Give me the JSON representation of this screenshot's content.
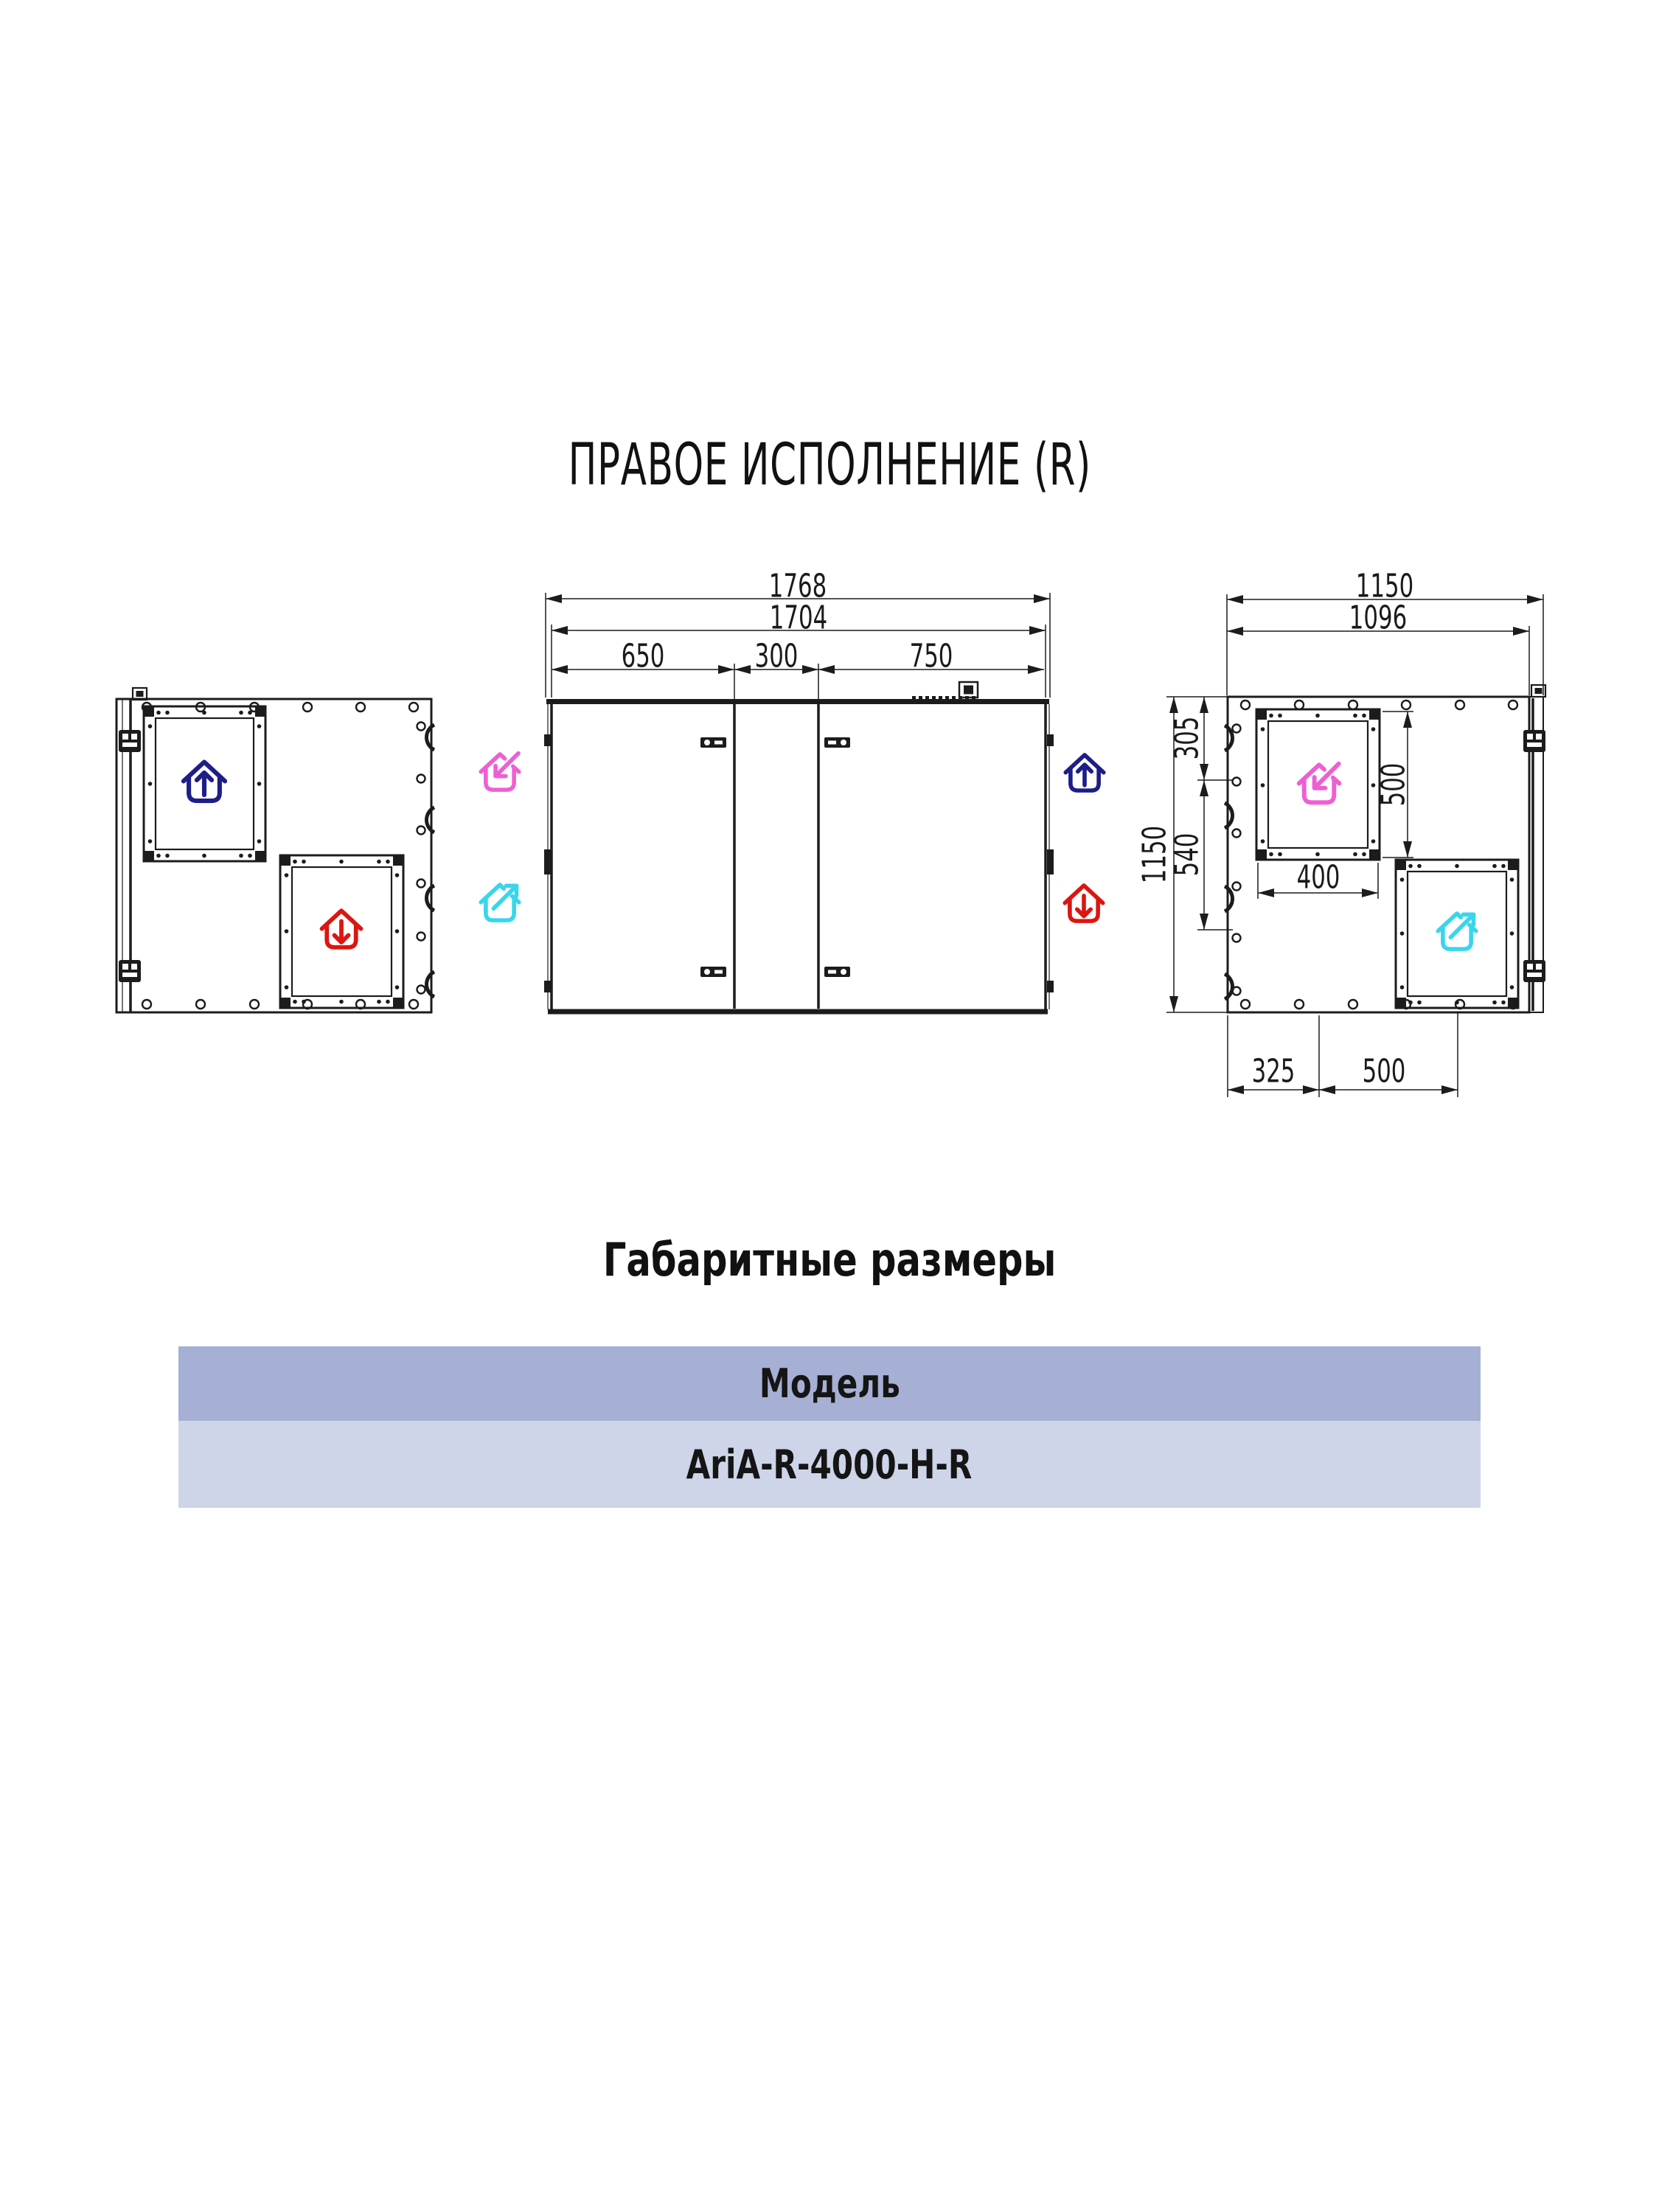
{
  "page": {
    "title": "ПРАВОЕ ИСПОЛНЕНИЕ (R)",
    "section_heading": "Габаритные размеры"
  },
  "table": {
    "header": "Модель",
    "model": "AriA-R-4000-H-R",
    "header_bg": "#a6b0d4",
    "row_bg": "#ced5e9"
  },
  "colors": {
    "line": "#1c1c1c",
    "house_up": "#1e1e88",
    "house_down": "#dc1511",
    "house_in": "#ee5fd3",
    "house_out": "#38d6ec"
  },
  "icons": {
    "house_up": "house-arrow-up-icon",
    "house_down": "house-arrow-down-icon",
    "house_in": "house-arrow-in-icon",
    "house_out": "house-arrow-out-icon"
  },
  "front_view": {
    "dims": {
      "overall_width": "1768",
      "body_width": "1704",
      "section_left": "650",
      "section_middle": "300",
      "section_right": "750"
    }
  },
  "side_view": {
    "dims": {
      "overall_depth": "1150",
      "body_depth": "1096",
      "top_offset": "305",
      "middle_offset": "540",
      "overall_height": "1150",
      "opening_height": "500",
      "opening_width": "400",
      "bottom_offset": "325",
      "bottom_opening_width": "500"
    }
  }
}
